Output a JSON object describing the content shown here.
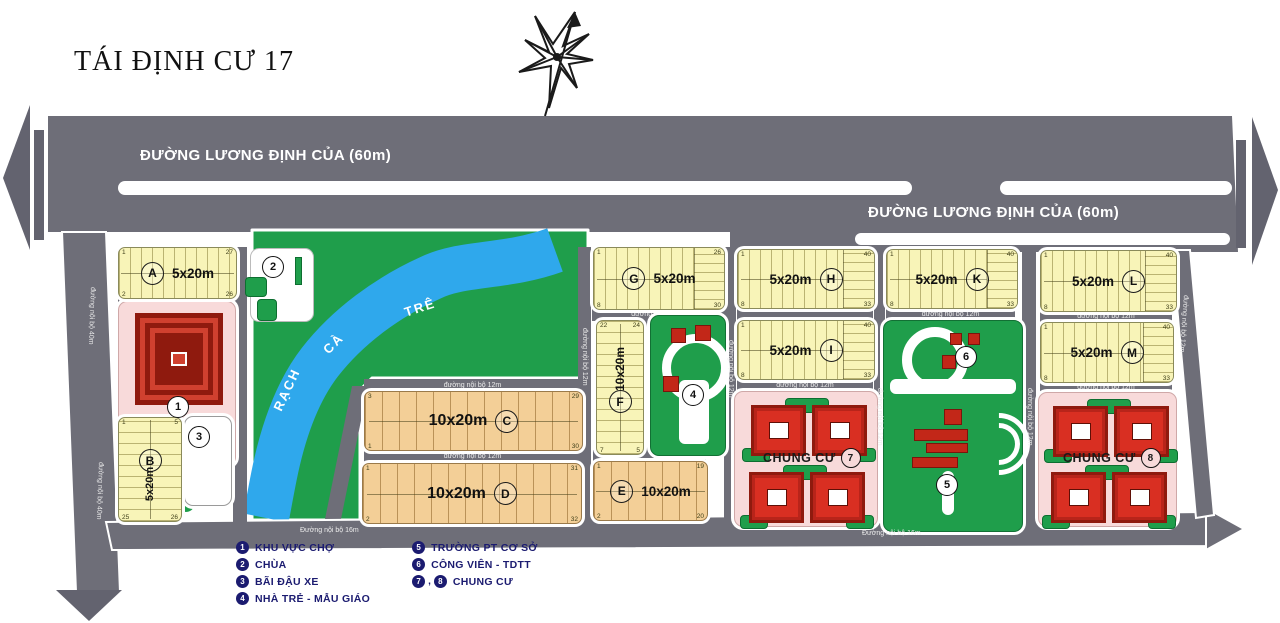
{
  "title": "TÁI ĐỊNH CƯ 17",
  "roads": {
    "main_label": "ĐƯỜNG LƯƠNG ĐỊNH CỦA (60m)",
    "internal_12m": "đường nội bộ 12m",
    "internal_16m": "Đường nội bộ 16m",
    "internal_40m": "đường nội bộ 40m"
  },
  "river": {
    "word1": "RẠCH",
    "word2": "CÀ",
    "word3": "TRÊ"
  },
  "blocks": {
    "A": {
      "letter": "A",
      "size": "5x20m",
      "num": {
        "tl": "1",
        "tr": "27",
        "bl": "2",
        "br": "26"
      }
    },
    "B": {
      "letter": "B",
      "size": "5x20m",
      "num": {
        "tl": "1",
        "tr": "5",
        "bl": "25",
        "br": "26"
      }
    },
    "C": {
      "letter": "C",
      "size": "10x20m",
      "num": {
        "tl": "3",
        "tr": "29",
        "bl": "1",
        "br": "30"
      }
    },
    "D": {
      "letter": "D",
      "size": "10x20m",
      "num": {
        "tl": "1",
        "tr": "31",
        "bl": "2",
        "br": "32"
      }
    },
    "E": {
      "letter": "E",
      "size": "10x20m",
      "num": {
        "tl": "1",
        "tr": "19",
        "bl": "2",
        "br": "20"
      }
    },
    "F": {
      "letter": "F",
      "size": "10x20m",
      "num": {
        "tl": "22",
        "tr": "24",
        "bl": "7",
        "br": "5"
      }
    },
    "G": {
      "letter": "G",
      "size": "5x20m",
      "num": {
        "tl": "1",
        "tr": "26",
        "bl": "8",
        "br": "30"
      }
    },
    "H": {
      "letter": "H",
      "size": "5x20m",
      "num": {
        "tl": "1",
        "tr": "40",
        "bl": "8",
        "br": "33"
      }
    },
    "I": {
      "letter": "I",
      "size": "5x20m",
      "num": {
        "tl": "1",
        "tr": "40",
        "bl": "8",
        "br": "33"
      }
    },
    "K": {
      "letter": "K",
      "size": "5x20m",
      "num": {
        "tl": "1",
        "tr": "40",
        "bl": "8",
        "br": "33"
      }
    },
    "L": {
      "letter": "L",
      "size": "5x20m",
      "num": {
        "tl": "1",
        "tr": "40",
        "bl": "8",
        "br": "33"
      }
    },
    "M": {
      "letter": "M",
      "size": "5x20m",
      "num": {
        "tl": "1",
        "tr": "40",
        "bl": "8",
        "br": "33"
      }
    }
  },
  "markers": {
    "m1": "1",
    "m2": "2",
    "m3": "3",
    "m4": "4",
    "m5": "5",
    "m6": "6",
    "m7": "7",
    "m8": "8"
  },
  "chung_cu_label": "CHUNG CƯ",
  "legend": {
    "items": [
      {
        "num": "1",
        "label": "KHU VỰC CHỢ"
      },
      {
        "num": "2",
        "label": "CHÙA"
      },
      {
        "num": "3",
        "label": "BÃI ĐẬU XE"
      },
      {
        "num": "4",
        "label": "NHÀ TRẺ - MẪU GIÁO"
      },
      {
        "num": "5",
        "label": "TRƯỜNG PT CƠ SỞ"
      },
      {
        "num": "6",
        "label": "CÔNG VIÊN - TDTT"
      }
    ],
    "item_78": {
      "num_a": "7",
      "num_b": "8",
      "separator": ",",
      "label": "CHUNG CƯ"
    }
  },
  "colors": {
    "road": "#6e6e78",
    "lot_yellow": "#f8f4b8",
    "lot_tan": "#f3cf97",
    "green": "#1f9e4b",
    "river": "#2fa8ec",
    "pink": "#f8dada",
    "building_red": "#d92f22",
    "legend_navy": "#1b1b70"
  }
}
